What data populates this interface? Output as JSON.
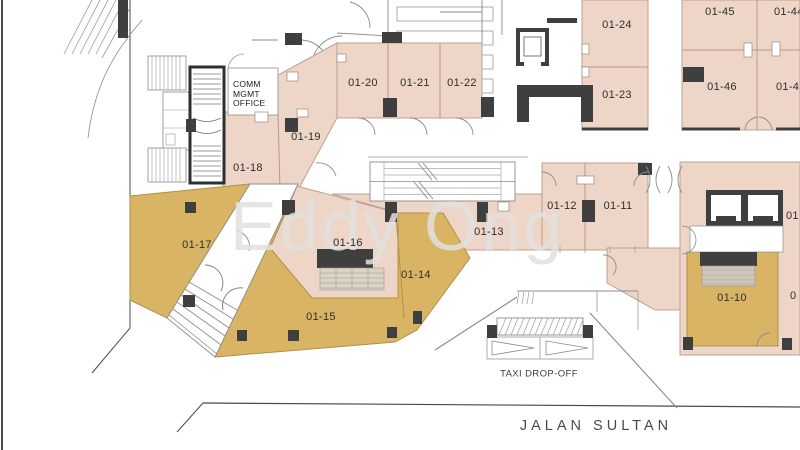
{
  "rooms": {
    "r10": {
      "label": "01-10"
    },
    "r11": {
      "label": "01-11"
    },
    "r12": {
      "label": "01-12"
    },
    "r13": {
      "label": "01-13"
    },
    "r14": {
      "label": "01-14"
    },
    "r15": {
      "label": "01-15"
    },
    "r16": {
      "label": "01-16"
    },
    "r17": {
      "label": "01-17"
    },
    "r18": {
      "label": "01-18"
    },
    "r19": {
      "label": "01-19"
    },
    "r20": {
      "label": "01-20"
    },
    "r21": {
      "label": "01-21"
    },
    "r22": {
      "label": "01-22"
    },
    "r23": {
      "label": "01-23"
    },
    "r24": {
      "label": "01-24"
    },
    "r44": {
      "label": "01-44"
    },
    "r45": {
      "label": "01-45"
    },
    "r46": {
      "label": "01-46"
    },
    "r47": {
      "label": "01-47"
    }
  },
  "partial_labels": {
    "right_mid": "01",
    "right_lower": "0"
  },
  "annotations": {
    "comm_office_line1": "COMM",
    "comm_office_line2": "MGMT",
    "comm_office_line3": "OFFICE",
    "taxi": "TAXI DROP-OFF",
    "street": "JALAN SULTAN"
  },
  "watermark": "Eddy Ong",
  "colors": {
    "unit_pink": "#edd6c7",
    "unit_gold": "#d8b464",
    "structure_dark": "#3f3f3f",
    "wall_gray": "#8b8b8b",
    "background": "#ffffff"
  }
}
